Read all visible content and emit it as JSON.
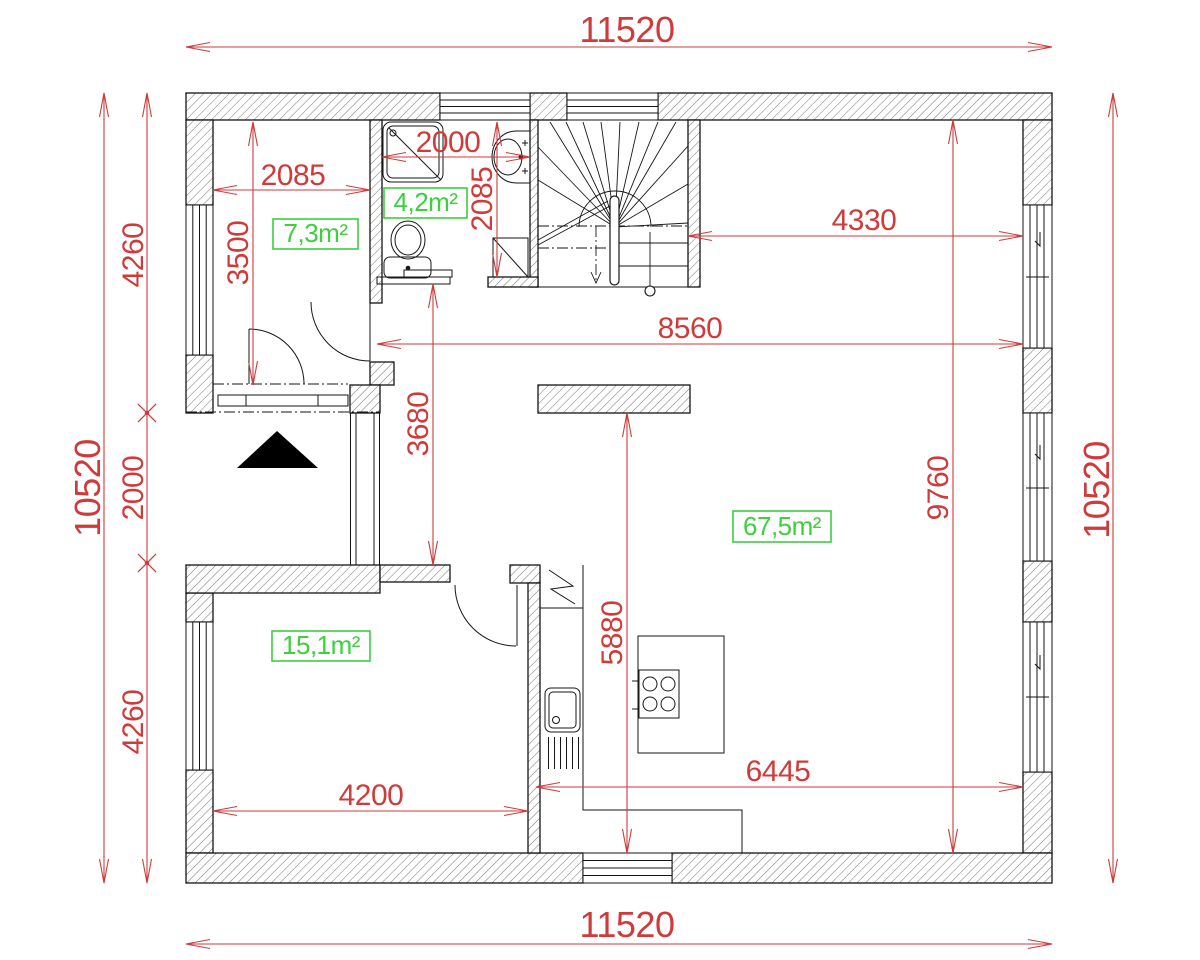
{
  "drawing": {
    "type": "architectural-floor-plan",
    "units": "mm",
    "symbols": {
      "entrance_marker": "filled-triangle",
      "hatch": "diagonal-wall-hatch"
    }
  },
  "colors": {
    "dimension": "#cf3b3b",
    "area_label": "#3ecf3e",
    "lines": "#161616"
  },
  "overall": {
    "width_top": "11520",
    "width_bottom": "11520",
    "height_left": "10520",
    "height_right": "10520"
  },
  "dimensions": [
    {
      "id": "top-width",
      "label": "11520",
      "x1": 186,
      "y1": 47,
      "x2": 1052,
      "y2": 47,
      "tx": 627,
      "ty": 42,
      "rot": 0,
      "fs": 36,
      "ends": "arrow-arrow"
    },
    {
      "id": "bottom-width",
      "label": "11520",
      "x1": 186,
      "y1": 944,
      "x2": 1052,
      "y2": 944,
      "tx": 627,
      "ty": 937,
      "rot": 0,
      "fs": 36,
      "ends": "arrow-arrow"
    },
    {
      "id": "left-height",
      "label": "10520",
      "x1": 104,
      "y1": 93,
      "x2": 104,
      "y2": 883,
      "tx": 100,
      "ty": 488,
      "rot": -90,
      "fs": 36,
      "ends": "arrow-arrow"
    },
    {
      "id": "right-height",
      "label": "10520",
      "x1": 1113,
      "y1": 93,
      "x2": 1113,
      "y2": 883,
      "tx": 1109,
      "ty": 490,
      "rot": -90,
      "fs": 36,
      "ends": "arrow-arrow"
    },
    {
      "id": "left-upper-4260",
      "label": "4260",
      "x1": 147,
      "y1": 93,
      "x2": 147,
      "y2": 413,
      "tx": 143,
      "ty": 255,
      "rot": -90,
      "fs": 30,
      "ends": "arrow-cross"
    },
    {
      "id": "left-2000",
      "label": "2000",
      "x1": 147,
      "y1": 413,
      "x2": 147,
      "y2": 563,
      "tx": 143,
      "ty": 488,
      "rot": -90,
      "fs": 30,
      "ends": "cross-cross"
    },
    {
      "id": "left-lower-4260",
      "label": "4260",
      "x1": 147,
      "y1": 563,
      "x2": 147,
      "y2": 883,
      "tx": 143,
      "ty": 722,
      "rot": -90,
      "fs": 30,
      "ends": "cross-arrow"
    },
    {
      "id": "room1-width",
      "label": "2085",
      "x1": 213,
      "y1": 190,
      "x2": 370,
      "y2": 190,
      "tx": 293,
      "ty": 185,
      "rot": 0,
      "fs": 30,
      "ends": "arrow-arrow"
    },
    {
      "id": "room1-height",
      "label": "3500",
      "x1": 253,
      "y1": 122,
      "x2": 253,
      "y2": 385,
      "tx": 248,
      "ty": 253,
      "rot": -90,
      "fs": 30,
      "ends": "arrow-arrow"
    },
    {
      "id": "bath-width",
      "label": "2000",
      "x1": 382,
      "y1": 157,
      "x2": 530,
      "y2": 157,
      "tx": 448,
      "ty": 152,
      "rot": 0,
      "fs": 30,
      "ends": "arrow-arrow"
    },
    {
      "id": "bath-height",
      "label": "2085",
      "x1": 497,
      "y1": 122,
      "x2": 497,
      "y2": 277,
      "tx": 492,
      "ty": 199,
      "rot": -90,
      "fs": 30,
      "ends": "arrow-arrow"
    },
    {
      "id": "landing-width",
      "label": "4330",
      "x1": 688,
      "y1": 236,
      "x2": 1023,
      "y2": 236,
      "tx": 864,
      "ty": 230,
      "rot": 0,
      "fs": 30,
      "ends": "arrow-arrow"
    },
    {
      "id": "living-width",
      "label": "8560",
      "x1": 377,
      "y1": 344,
      "x2": 1023,
      "y2": 344,
      "tx": 690,
      "ty": 338,
      "rot": 0,
      "fs": 30,
      "ends": "arrow-arrow"
    },
    {
      "id": "hall-height",
      "label": "3680",
      "x1": 433,
      "y1": 284,
      "x2": 433,
      "y2": 565,
      "tx": 428,
      "ty": 424,
      "rot": -90,
      "fs": 30,
      "ends": "arrow-arrow"
    },
    {
      "id": "living-height",
      "label": "9760",
      "x1": 953,
      "y1": 120,
      "x2": 953,
      "y2": 853,
      "tx": 948,
      "ty": 488,
      "rot": -90,
      "fs": 30,
      "ends": "arrow-arrow"
    },
    {
      "id": "kitchen-height",
      "label": "5880",
      "x1": 627,
      "y1": 413,
      "x2": 627,
      "y2": 853,
      "tx": 622,
      "ty": 633,
      "rot": -90,
      "fs": 30,
      "ends": "arrow-arrow"
    },
    {
      "id": "dining-width",
      "label": "6445",
      "x1": 536,
      "y1": 787,
      "x2": 1023,
      "y2": 787,
      "tx": 778,
      "ty": 781,
      "rot": 0,
      "fs": 30,
      "ends": "arrow-arrow"
    },
    {
      "id": "room2-width",
      "label": "4200",
      "x1": 213,
      "y1": 811,
      "x2": 528,
      "y2": 811,
      "tx": 371,
      "ty": 805,
      "rot": 0,
      "fs": 30,
      "ends": "arrow-arrow"
    }
  ],
  "area_labels": [
    {
      "id": "room1-area",
      "label": "7,3m²",
      "x": 273,
      "y": 219,
      "w": 85,
      "h": 30
    },
    {
      "id": "bathroom-area",
      "label": "4,2m²",
      "x": 384,
      "y": 188,
      "w": 83,
      "h": 30
    },
    {
      "id": "room2-area",
      "label": "15,1m²",
      "x": 272,
      "y": 631,
      "w": 98,
      "h": 30
    },
    {
      "id": "living-area",
      "label": "67,5m²",
      "x": 733,
      "y": 511,
      "w": 98,
      "h": 31
    }
  ]
}
